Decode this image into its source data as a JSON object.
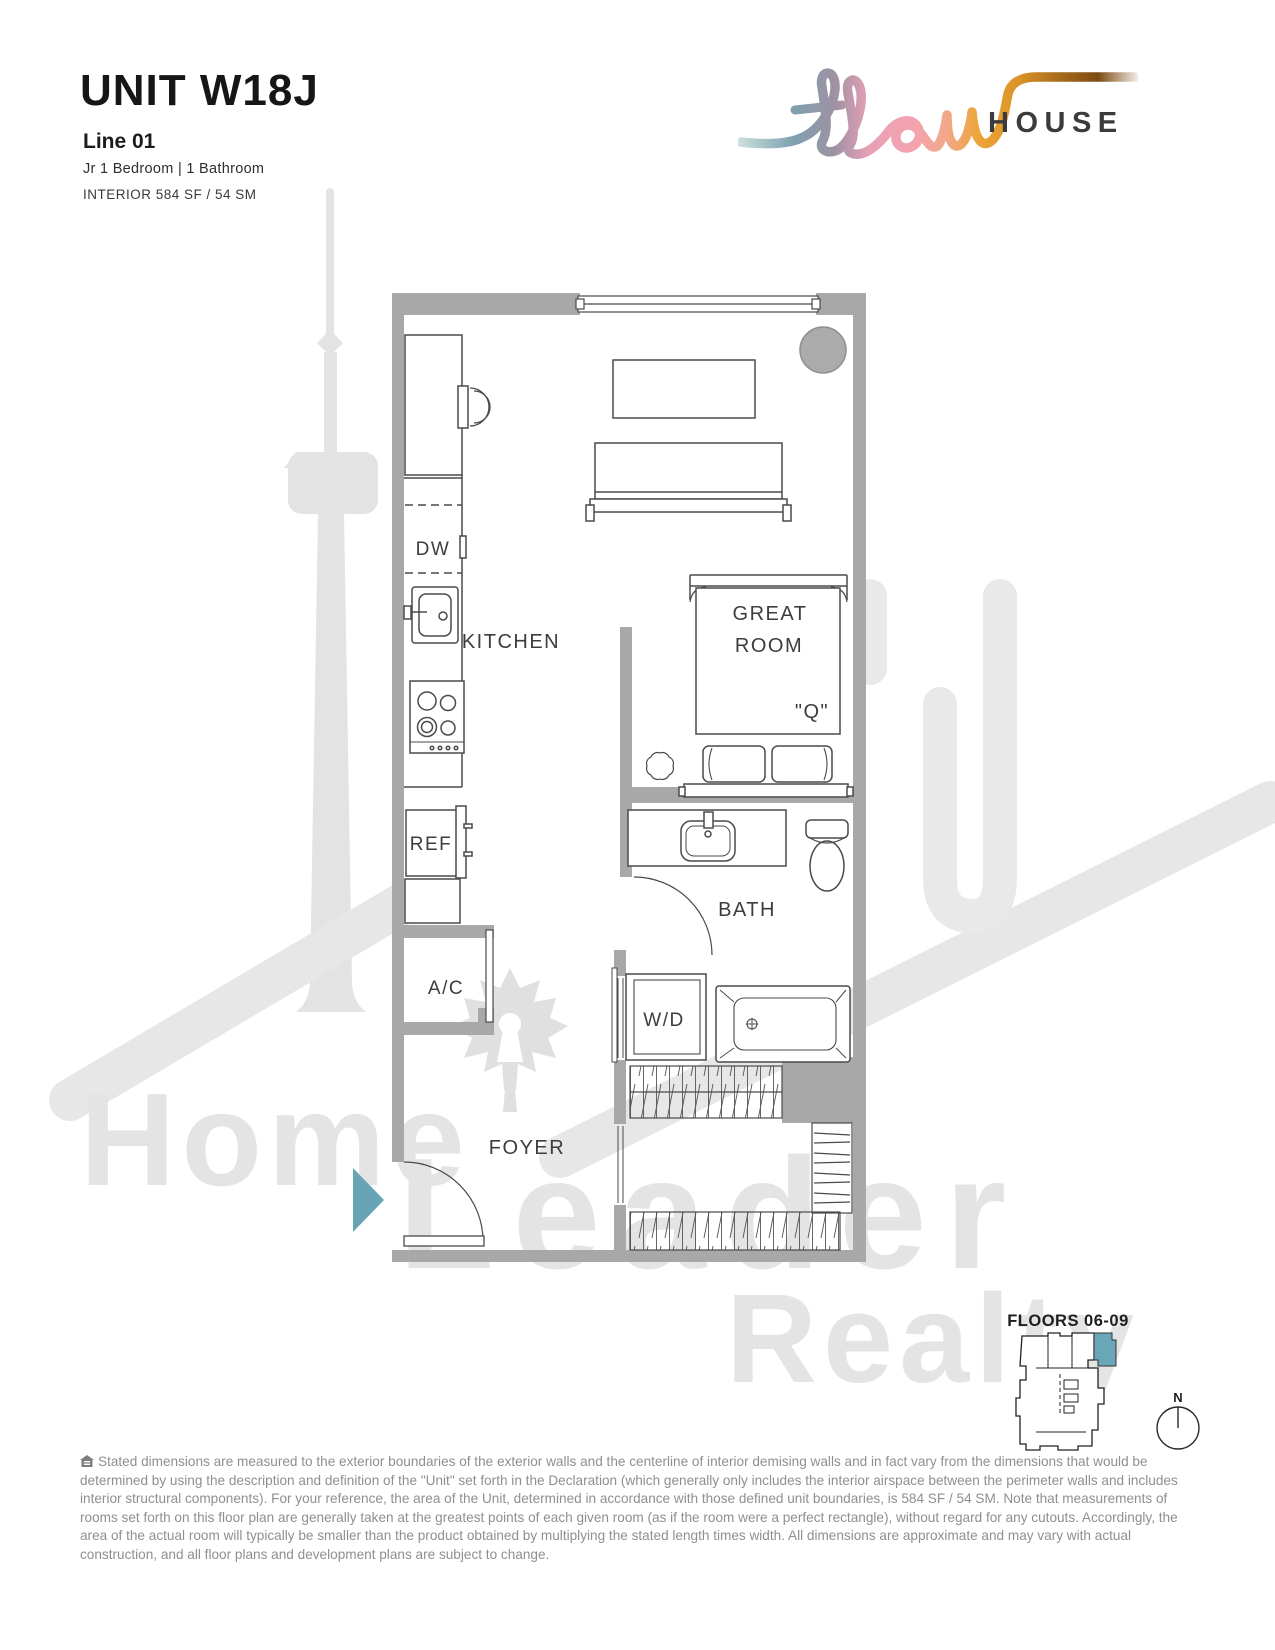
{
  "header": {
    "unit": "UNIT W18J",
    "line": "Line 01",
    "specs": "Jr 1 Bedroom | 1 Bathroom",
    "area": "INTERIOR 584 SF / 54 SM"
  },
  "logo": {
    "script_word": "flow",
    "word": "HOUSE"
  },
  "plan": {
    "labels": {
      "kitchen": "KITCHEN",
      "great1": "GREAT",
      "great2": "ROOM",
      "bath": "BATH",
      "foyer": "FOYER",
      "dw": "DW",
      "ref": "REF",
      "ac": "A/C",
      "wd": "W/D",
      "bed_size": "\"Q\""
    }
  },
  "keyplan": {
    "floors": "FLOORS 06-09",
    "north": "N",
    "highlight_color": "#69a7b8"
  },
  "watermark": {
    "word1": "Home",
    "word2": "Leader",
    "word3": "Realty"
  },
  "disclaimer": {
    "text": "Stated dimensions are measured to the exterior boundaries of the exterior walls and the centerline of interior demising walls and in fact vary from the dimensions that would be determined by using the description and definition of the \"Unit\" set forth in the Declaration (which generally only includes the interior airspace between the perimeter walls and includes interior structural components).  For your reference, the area of the Unit, determined in accordance with those defined unit boundaries, is 584 SF / 54 SM. Note that measurements of rooms set forth on this floor plan are generally taken at the greatest points of each given room (as if the room were a perfect rectangle), without regard for any cutouts.  Accordingly, the area of the actual room will typically be smaller than the product obtained by multiplying the stated length times width.  All dimensions are approximate and may vary with actual construction, and all floor plans and development plans are subject to change."
  },
  "colors": {
    "wall": "#a8a8a8",
    "accent_teal": "#69a4b6",
    "plan_line": "#4a4a4a",
    "watermark_gray": "#e4e4e4",
    "logo_text": "#3b3b3b"
  }
}
